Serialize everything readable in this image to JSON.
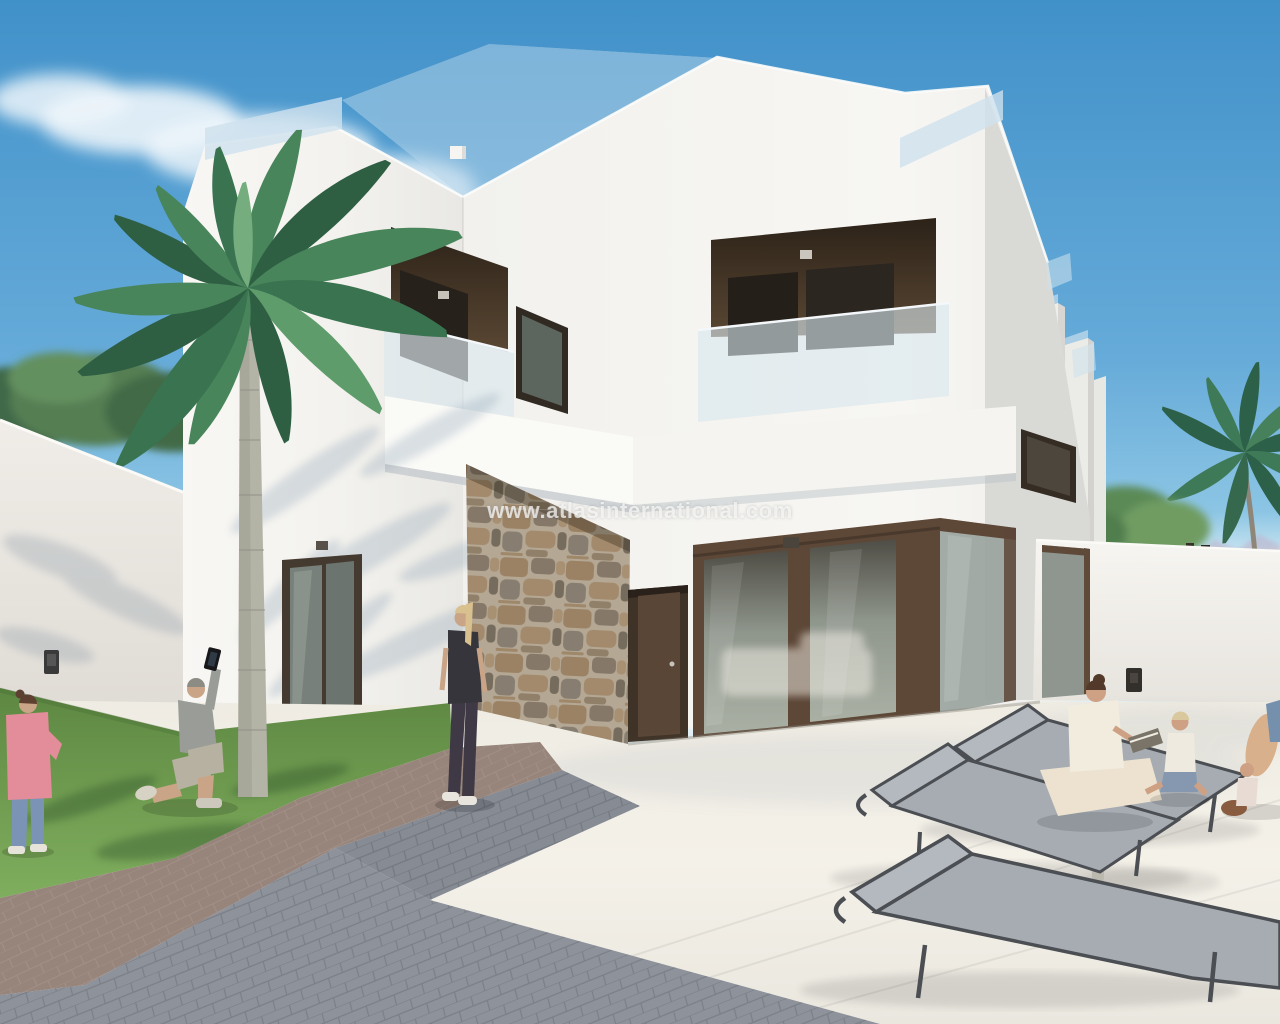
{
  "watermark": {
    "text": "www.atlasinternational.com"
  },
  "scene": {
    "type": "architectural-3d-render",
    "subject": "modern two-storey white villa with roof terrace, glass balustrades, stone feature pillar, palm tree, lawn and sun terrace with loungers"
  },
  "colors": {
    "sky_top": "#4191c9",
    "sky_mid": "#66abd9",
    "sky_horizon": "#cfe8f2",
    "wall_white": "#f6f5f1",
    "wall_shade": "#d9d9d6",
    "fascia_white": "#fafaf7",
    "frame_brown": "#5d4737",
    "recess_brown": "#33281e",
    "glass_gray": "#8f968c",
    "balustrade_glass": "#d9e6ed",
    "stone_tan": "#a78d6d",
    "grass_green": "#6f9b50",
    "path_brown": "#97847a",
    "paver_gray": "#8e929b",
    "terrace_cream": "#f2efe7",
    "lounger_frame": "#4b4e53",
    "lounger_mesh": "#a6acb2",
    "foliage_green": "#49855b",
    "trunk_gray": "#b3b3a6",
    "skin": "#c9a486",
    "shirt_pink": "#e28d99",
    "jeans_blue": "#7b93b5",
    "outfit_black": "#35353b",
    "tee_white": "#f2ecdf",
    "mountain_mauve": "#bfaec6",
    "watermark": "rgba(250,250,250,0.75)"
  }
}
